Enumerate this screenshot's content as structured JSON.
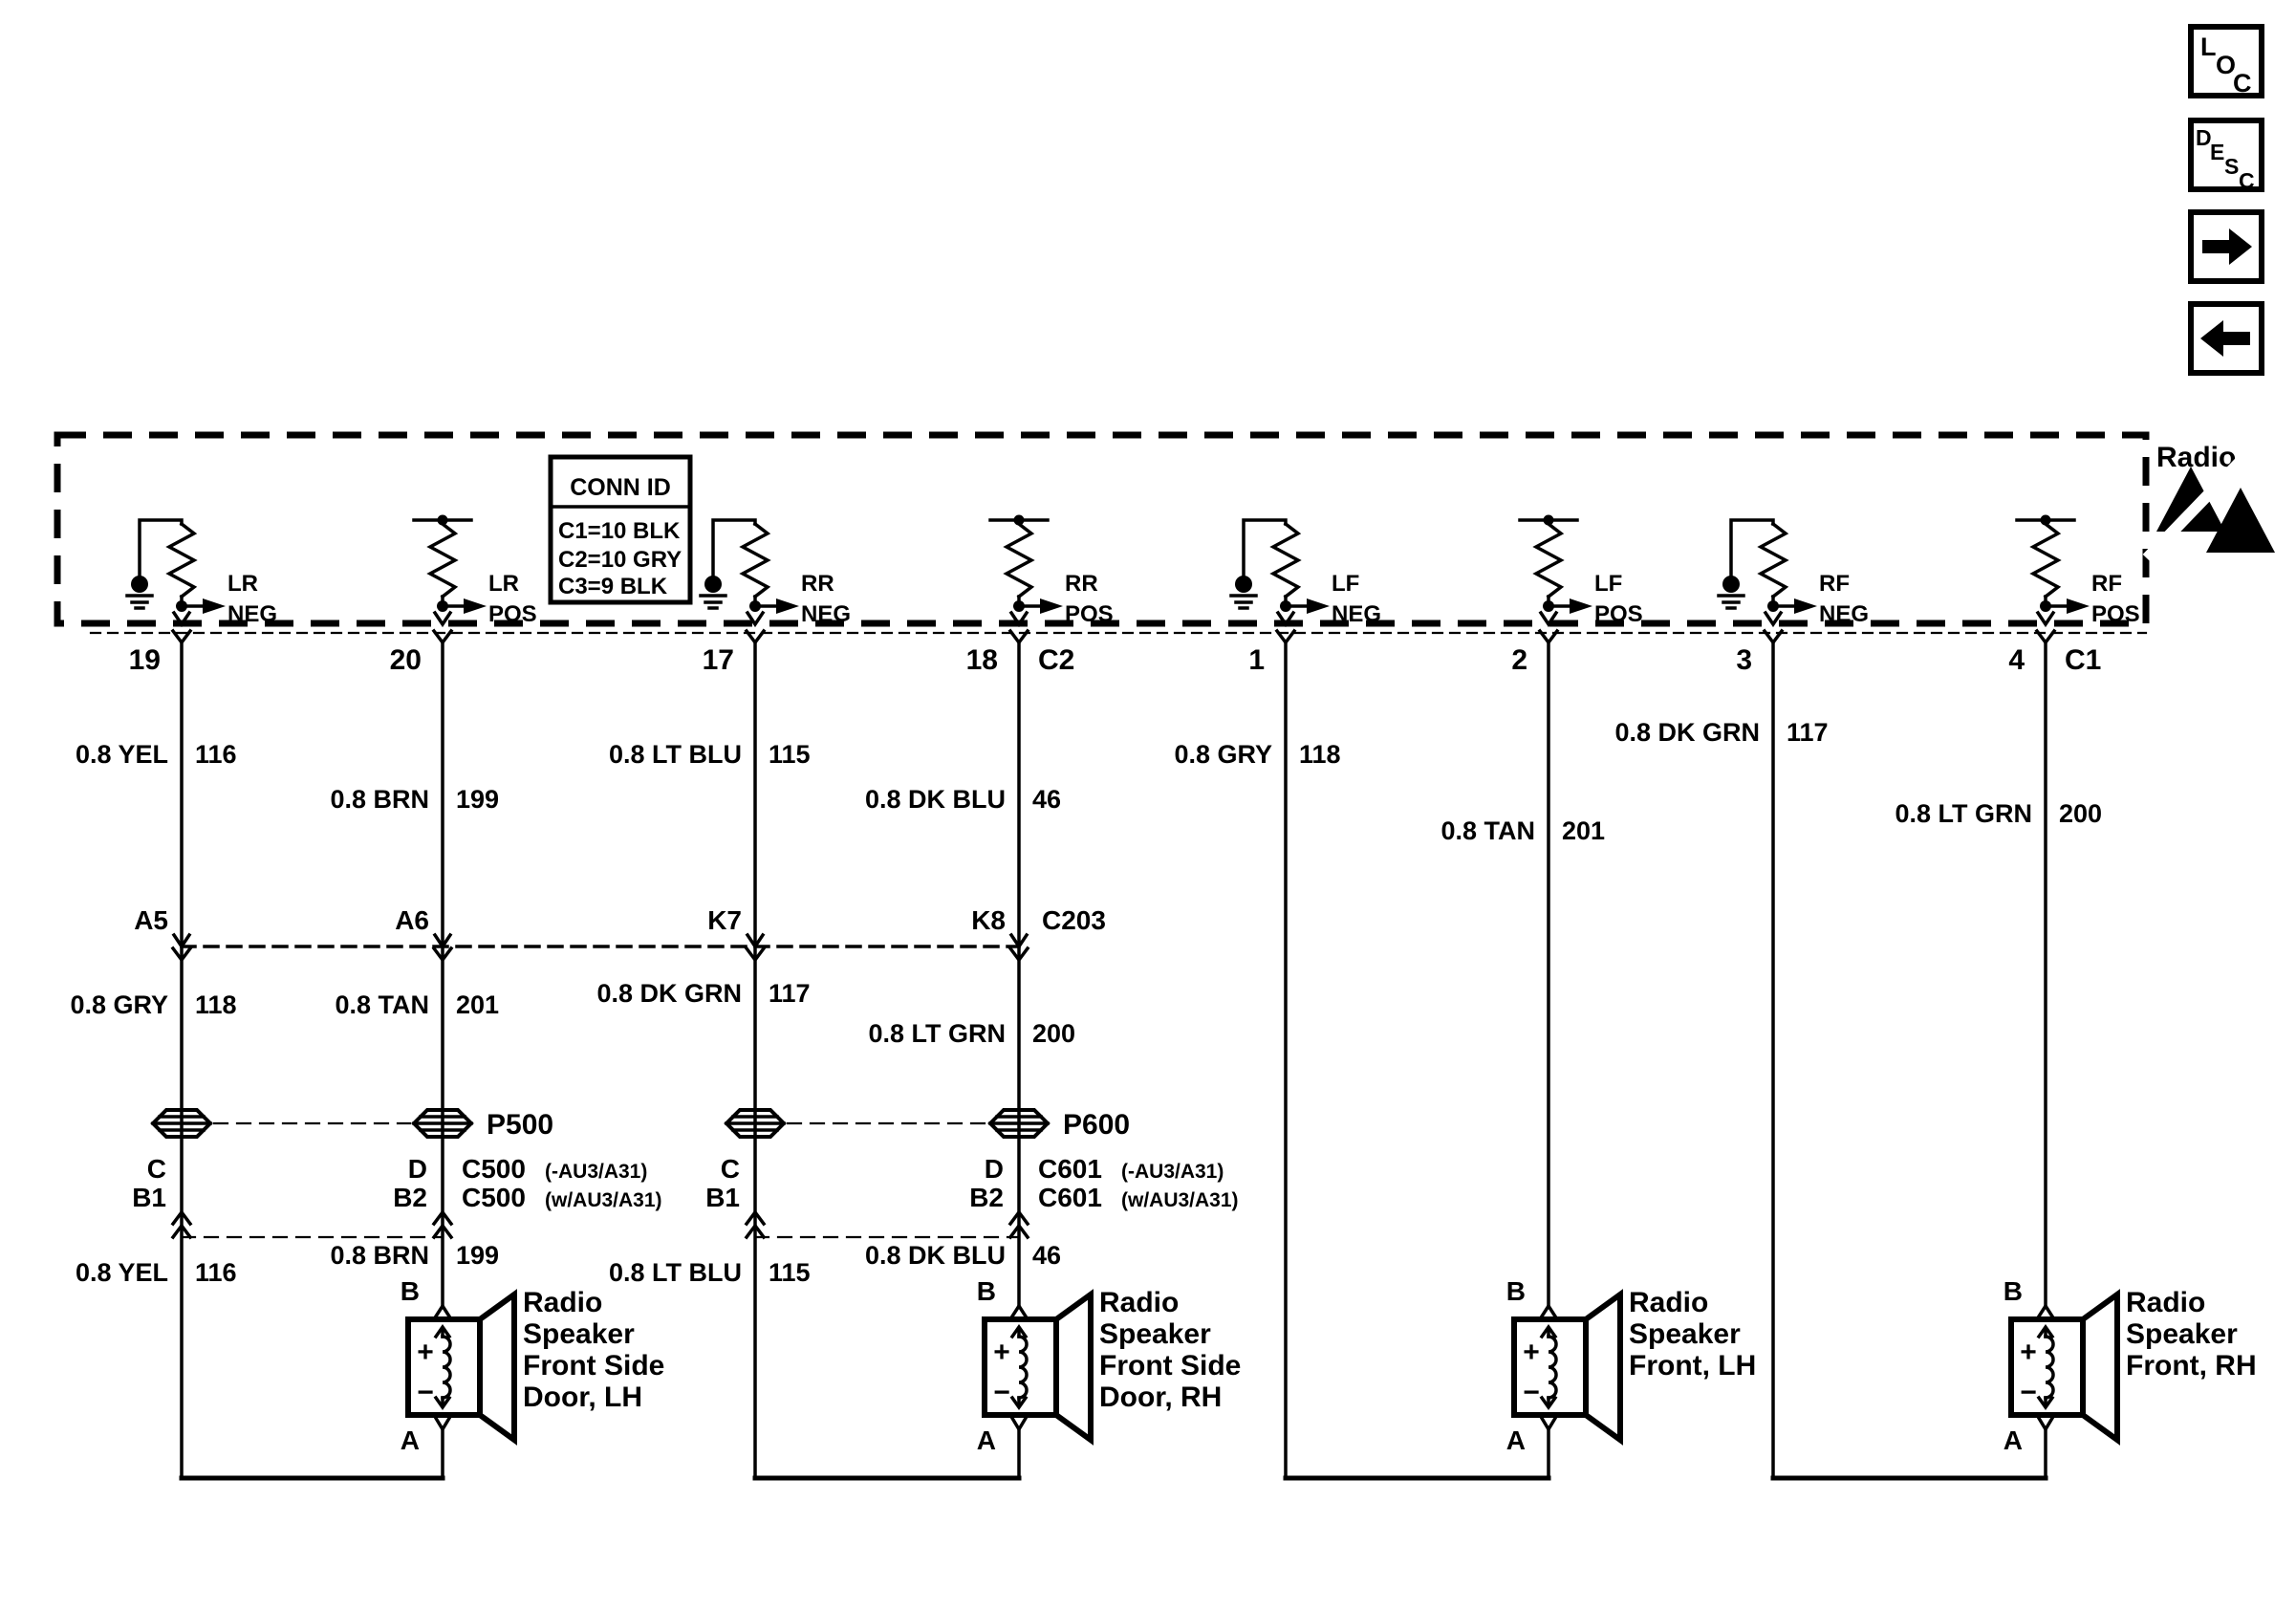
{
  "nav": {
    "loc": [
      "L",
      "O",
      "C"
    ],
    "desc": [
      "D",
      "E",
      "S",
      "C"
    ]
  },
  "radio": {
    "label": "Radio",
    "conn_id": {
      "title": "CONN ID",
      "rows": [
        "C1=10 BLK",
        "C2=10 GRY",
        "C3=9 BLK"
      ]
    },
    "channels": [
      {
        "group": "LR",
        "polarity": "NEG"
      },
      {
        "group": "LR",
        "polarity": "POS"
      },
      {
        "group": "RR",
        "polarity": "NEG"
      },
      {
        "group": "RR",
        "polarity": "POS"
      },
      {
        "group": "LF",
        "polarity": "NEG"
      },
      {
        "group": "LF",
        "polarity": "POS"
      },
      {
        "group": "RF",
        "polarity": "NEG"
      },
      {
        "group": "RF",
        "polarity": "POS"
      }
    ]
  },
  "harness": {
    "pins": [
      "19",
      "20",
      "17",
      "18",
      "1",
      "2",
      "3",
      "4"
    ],
    "radio_connectors": {
      "left": "C2",
      "right": "C1"
    },
    "upper_wires": [
      {
        "gauge_color": "0.8 YEL",
        "circuit": "116"
      },
      {
        "gauge_color": "0.8 BRN",
        "circuit": "199"
      },
      {
        "gauge_color": "0.8 LT BLU",
        "circuit": "115"
      },
      {
        "gauge_color": "0.8 DK BLU",
        "circuit": "46"
      },
      {
        "gauge_color": "0.8 GRY",
        "circuit": "118"
      },
      {
        "gauge_color": "0.8 TAN",
        "circuit": "201"
      },
      {
        "gauge_color": "0.8 DK GRN",
        "circuit": "117"
      },
      {
        "gauge_color": "0.8 LT GRN",
        "circuit": "200"
      }
    ],
    "c203": {
      "pins": [
        "A5",
        "A6",
        "K7",
        "K8"
      ],
      "label": "C203"
    },
    "middle_wires": [
      {
        "gauge_color": "0.8 GRY",
        "circuit": "118"
      },
      {
        "gauge_color": "0.8 TAN",
        "circuit": "201"
      },
      {
        "gauge_color": "0.8 DK GRN",
        "circuit": "117"
      },
      {
        "gauge_color": "0.8 LT GRN",
        "circuit": "200"
      }
    ],
    "pass_throughs": {
      "left": "P500",
      "right": "P600"
    },
    "c500": {
      "pins_top": [
        "C",
        "D"
      ],
      "pins_bottom": [
        "B1",
        "B2"
      ],
      "label": "C500",
      "variant_top": "(-AU3/A31)",
      "variant_bottom": "(w/AU3/A31)"
    },
    "c601": {
      "pins_top": [
        "C",
        "D"
      ],
      "pins_bottom": [
        "B1",
        "B2"
      ],
      "label": "C601",
      "variant_top": "(-AU3/A31)",
      "variant_bottom": "(w/AU3/A31)"
    },
    "lower_wires": [
      {
        "gauge_color": "0.8 YEL",
        "circuit": "116"
      },
      {
        "gauge_color": "0.8 BRN",
        "circuit": "199"
      },
      {
        "gauge_color": "0.8 LT BLU",
        "circuit": "115"
      },
      {
        "gauge_color": "0.8 DK BLU",
        "circuit": "46"
      }
    ]
  },
  "speakers": [
    {
      "pin_top": "B",
      "pin_bottom": "A",
      "plus": "+",
      "minus": "−",
      "lines": [
        "Radio",
        "Speaker",
        "Front Side",
        "Door, LH"
      ]
    },
    {
      "pin_top": "B",
      "pin_bottom": "A",
      "plus": "+",
      "minus": "−",
      "lines": [
        "Radio",
        "Speaker",
        "Front Side",
        "Door, RH"
      ]
    },
    {
      "pin_top": "B",
      "pin_bottom": "A",
      "plus": "+",
      "minus": "−",
      "lines": [
        "Radio",
        "Speaker",
        "Front, LH"
      ]
    },
    {
      "pin_top": "B",
      "pin_bottom": "A",
      "plus": "+",
      "minus": "−",
      "lines": [
        "Radio",
        "Speaker",
        "Front, RH"
      ]
    }
  ],
  "colors": {
    "ink": "#000000",
    "background": "#ffffff"
  }
}
